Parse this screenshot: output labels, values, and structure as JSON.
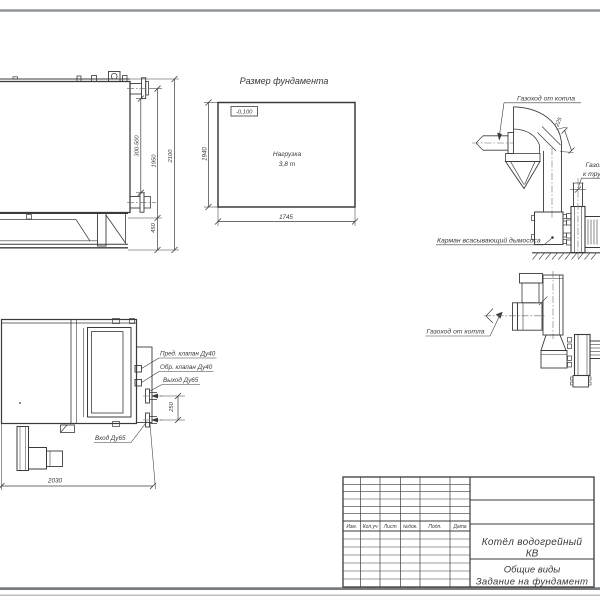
{
  "page": {
    "background": "#ffffff",
    "line_color": "#3b3b3b",
    "border_color": "#8f9496"
  },
  "side_view": {
    "dims": {
      "nozzle_range": "300-500",
      "height_to_flange": "1950",
      "total_height": "2100",
      "base_height": "450"
    }
  },
  "foundation": {
    "title": "Размер фундамента",
    "level_mark": "-0,100",
    "load_line1": "Нагрузка",
    "load_line2": "3,8 т",
    "dim_height": "1940",
    "dim_width": "1745"
  },
  "flue_elevation": {
    "label_from_boiler": "Газоход от котла",
    "label_pocket": "Карман всасывающий дымососа",
    "label_to_chimney_line1": "Газоход",
    "label_to_chimney_line2": "к трубе",
    "dim_duct": "225"
  },
  "flue_plan": {
    "label_from_boiler": "Газоход от котла"
  },
  "plan_view": {
    "labels": {
      "safety_valve": "Пред. клапан Ду40",
      "check_valve": "Обр. клапан Ду40",
      "outlet": "Выход Ду65",
      "inlet": "Вход Ду65"
    },
    "dims": {
      "pipe_spacing": "250",
      "length": "2030"
    }
  },
  "title_block": {
    "headers": [
      "Изм.",
      "Кол.уч",
      "Лист",
      "№док.",
      "Подп.",
      "Дата"
    ],
    "doc_title_line1": "Котёл водогрейный",
    "doc_title_line2": "КВ",
    "view_type": "Общие виды",
    "subtitle": "Задание на фундамент"
  }
}
